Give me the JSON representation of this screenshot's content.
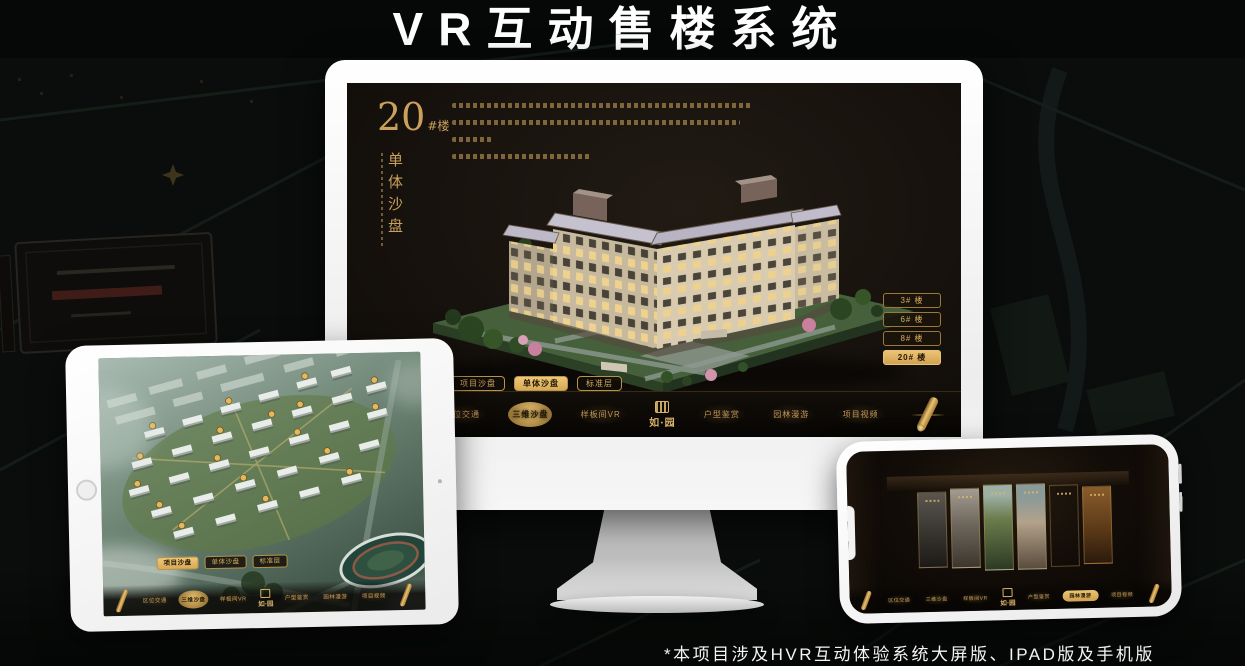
{
  "page": {
    "title": "VR互动售楼系统",
    "footnote": "*本项目涉及HVR互动体验系统大屏版、IPAD版及手机版"
  },
  "colors": {
    "gold": "#d2a75c",
    "gold_bright": "#ecc476",
    "active_pill_bg": "#e2b660",
    "screen_bg": "#17120d",
    "poster_bg": "#0a0d0b",
    "device_frame": "#f5f5f5",
    "title_text": "#ffffff"
  },
  "monitor": {
    "building_no": "20",
    "building_no_suffix": "#楼",
    "building_subtitle": "单体沙盘",
    "floor_buttons": [
      {
        "label": "3# 楼",
        "active": false
      },
      {
        "label": "6# 楼",
        "active": false
      },
      {
        "label": "8# 楼",
        "active": false
      },
      {
        "label": "20# 楼",
        "active": true
      }
    ],
    "tabs": [
      {
        "label": "项目沙盘",
        "active": false
      },
      {
        "label": "单体沙盘",
        "active": true
      },
      {
        "label": "标准层",
        "active": false
      }
    ],
    "nav_left": [
      {
        "label": "区位交通",
        "active": false
      },
      {
        "label": "三维沙盘",
        "active": true
      },
      {
        "label": "样板间VR",
        "active": false
      }
    ],
    "logo": "如·园",
    "nav_right": [
      {
        "label": "户型鉴赏",
        "active": false
      },
      {
        "label": "园林漫游",
        "active": false
      },
      {
        "label": "项目视频",
        "active": false
      }
    ]
  },
  "tablet": {
    "tabs": [
      {
        "label": "项目沙盘",
        "active": true
      },
      {
        "label": "单体沙盘",
        "active": false
      },
      {
        "label": "标准层",
        "active": false
      }
    ],
    "nav_left": [
      {
        "label": "区位交通",
        "active": false
      },
      {
        "label": "三维沙盘",
        "active": true
      },
      {
        "label": "样板间VR",
        "active": false
      }
    ],
    "logo": "如·园",
    "nav_right": [
      {
        "label": "户型鉴赏",
        "active": false
      },
      {
        "label": "园林漫游",
        "active": false
      },
      {
        "label": "项目视频",
        "active": false
      }
    ]
  },
  "phone": {
    "nav_left": [
      {
        "label": "区位交通",
        "active": false
      },
      {
        "label": "三维沙盘",
        "active": false
      },
      {
        "label": "样板间VR",
        "active": false
      }
    ],
    "logo": "如·园",
    "nav_right": [
      {
        "label": "户型鉴赏",
        "active": false
      },
      {
        "label": "园林漫游",
        "active": true
      },
      {
        "label": "项目视频",
        "active": false
      }
    ]
  }
}
